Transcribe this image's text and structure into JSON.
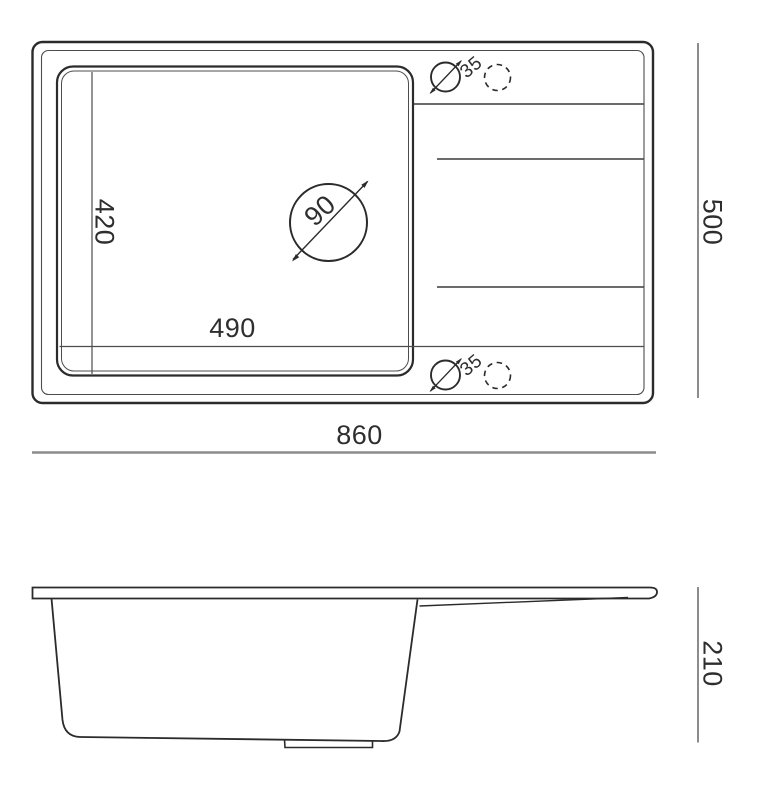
{
  "page": {
    "background": "#ffffff"
  },
  "drawing": {
    "kind": "technical-dimension-drawing",
    "subject": "kitchen sink with bowl and drainboard, top view and side view",
    "units": "mm",
    "colors": {
      "outline": "#2b2b2b",
      "dimension_line": "#8c8c8c",
      "text": "#2e2e2e",
      "background": "#ffffff"
    },
    "top_view": {
      "overall_width": "860",
      "overall_depth": "500",
      "bowl_width": "490",
      "bowl_depth": "420",
      "drain_hole_diameter": "90",
      "tap_hole_top_diameter": "35",
      "tap_hole_bottom_diameter": "35"
    },
    "side_view": {
      "overall_height": "210"
    }
  }
}
